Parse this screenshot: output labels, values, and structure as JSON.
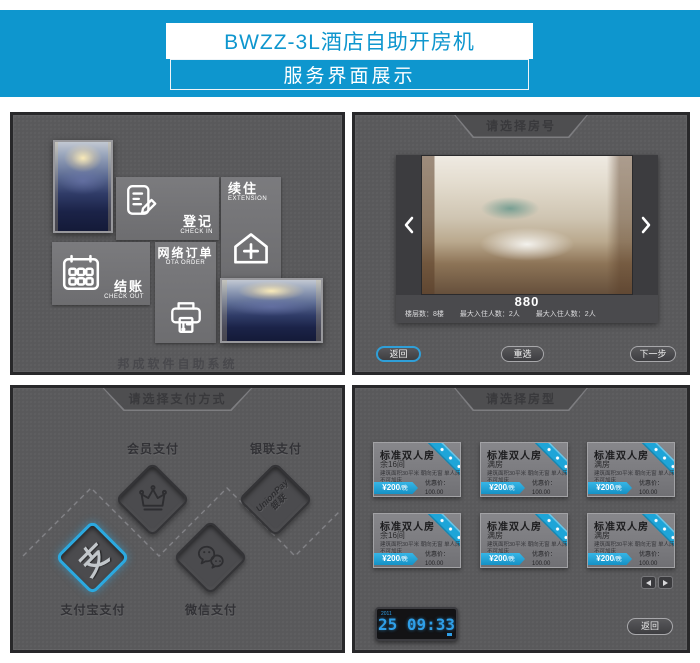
{
  "banner": {
    "title": "BWZZ-3L酒店自助开房机",
    "subtitle": "服务界面展示",
    "accent_color": "#0e96ce"
  },
  "main_menu": {
    "tiles": [
      {
        "label": "登记",
        "sublabel": "CHECK IN",
        "icon": "register-icon"
      },
      {
        "label": "续住",
        "sublabel": "EXTENSION",
        "icon": "house-plus-icon"
      },
      {
        "label": "网络订单",
        "sublabel": "OTA ORDER",
        "icon": "printer-icon"
      },
      {
        "label": "结账",
        "sublabel": "CHECK OUT",
        "icon": "calendar-icon"
      }
    ],
    "footer": "邦成软件自助系统"
  },
  "room_number": {
    "header": "请选择房号",
    "room_no": "880",
    "details": [
      "楼层数：8楼",
      "最大入住人数：2人",
      "最大入住人数：2人"
    ],
    "buttons": {
      "back": "返回",
      "reselect": "重选",
      "next": "下一步"
    },
    "carousel_icons": {
      "prev": "chevron-left-icon",
      "next": "chevron-right-icon"
    }
  },
  "payment": {
    "header": "请选择支付方式",
    "methods": [
      {
        "label": "会员支付",
        "icon": "crown-icon"
      },
      {
        "label": "银联支付",
        "icon": "unionpay-icon",
        "logo_line1": "UnionPay",
        "logo_line2": "银联"
      },
      {
        "label": "支付宝支付",
        "icon": "alipay-icon",
        "glyph": "支",
        "highlighted": true,
        "highlight_color": "#2ba9e0"
      },
      {
        "label": "微信支付",
        "icon": "wechat-icon"
      }
    ]
  },
  "room_type": {
    "header": "请选择房型",
    "cards": [
      {
        "title": "标准双人房",
        "avail": "余16间",
        "spec": "建筑面积30平米  朝向无窗  单人床1.2米",
        "spec2": "不可加床",
        "price": "¥200",
        "unit": "/晚",
        "discount": "优惠价：100.00",
        "member": "会员价：80.00"
      },
      {
        "title": "标准双人房",
        "avail": "满房",
        "spec": "建筑面积30平米  朝向无窗  单人床1.2米",
        "spec2": "不可加床",
        "price": "¥200",
        "unit": "/晚",
        "discount": "优惠价：100.00",
        "member": "会员价：80.00"
      },
      {
        "title": "标准双人房",
        "avail": "满房",
        "spec": "建筑面积30平米  朝向无窗  单人床1.2米",
        "spec2": "不可加床",
        "price": "¥200",
        "unit": "/晚",
        "discount": "优惠价：100.00",
        "member": "会员价：80.00"
      },
      {
        "title": "标准双人房",
        "avail": "余16间",
        "spec": "建筑面积30平米  朝向无窗  单人床1.2米",
        "spec2": "不可加床",
        "price": "¥200",
        "unit": "/晚",
        "discount": "优惠价：100.00",
        "member": "会员价：80.00"
      },
      {
        "title": "标准双人房",
        "avail": "满房",
        "spec": "建筑面积30平米  朝向无窗  单人床1.2米",
        "spec2": "不可加床",
        "price": "¥200",
        "unit": "/晚",
        "discount": "优惠价：100.00",
        "member": "会员价：80.00"
      },
      {
        "title": "标准双人房",
        "avail": "满房",
        "spec": "建筑面积30平米  朝向无窗  单人床1.2米",
        "spec2": "不可加床",
        "price": "¥200",
        "unit": "/晚",
        "discount": "优惠价：100.00",
        "member": "会员价：80.00"
      }
    ],
    "pager_icons": {
      "prev": "arrow-left-icon",
      "next": "arrow-right-icon"
    },
    "clock": {
      "date_small": "2011",
      "day": "25",
      "time": "09:33"
    },
    "back": "返回"
  }
}
